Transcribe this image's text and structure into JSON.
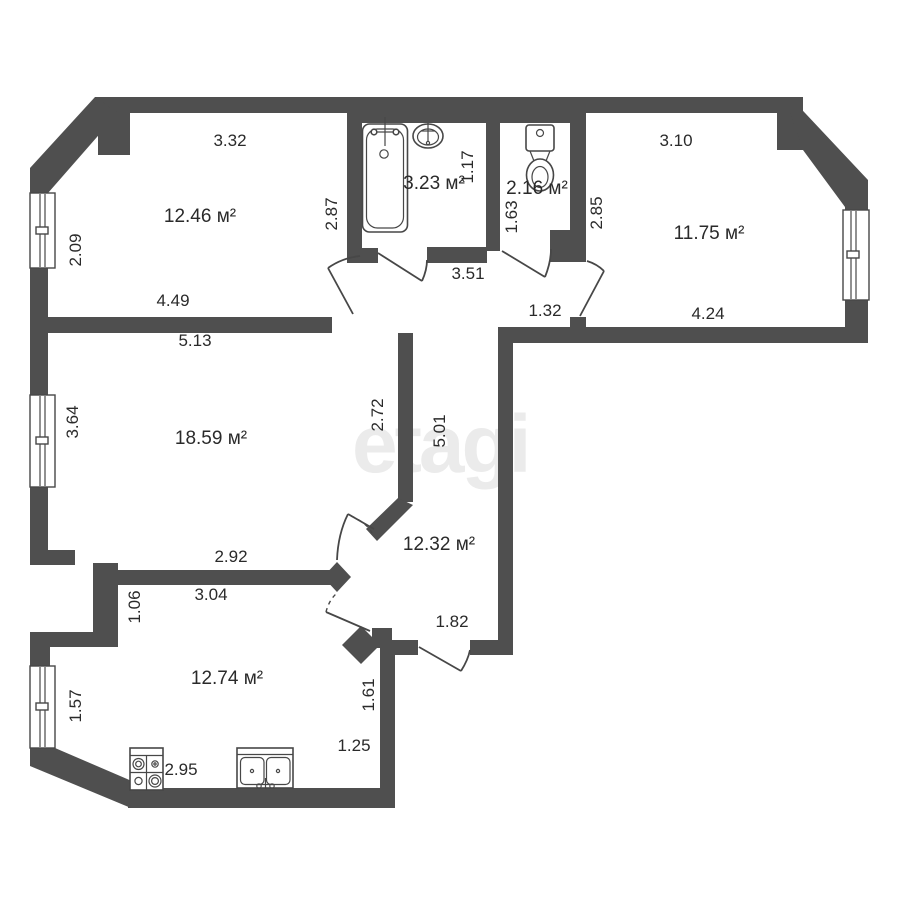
{
  "watermark": "etagi",
  "colors": {
    "wall": "#4f4f4f",
    "line": "#474747",
    "text": "#2a2a2a",
    "watermark": "#ebebeb"
  },
  "plan": {
    "type": "apartment-floor-plan",
    "area_unit": "м²",
    "rooms": [
      {
        "name": "room-12-46",
        "label": "12.46 м²",
        "x": 200,
        "y": 217
      },
      {
        "name": "bathroom",
        "label": "3.23 м²",
        "x": 434,
        "y": 184
      },
      {
        "name": "wc",
        "label": "2.16 м²",
        "x": 537,
        "y": 189
      },
      {
        "name": "room-11-75",
        "label": "11.75 м²",
        "x": 709,
        "y": 234
      },
      {
        "name": "room-18-59",
        "label": "18.59 м²",
        "x": 211,
        "y": 439
      },
      {
        "name": "hallway",
        "label": "12.32 м²",
        "x": 439,
        "y": 545
      },
      {
        "name": "kitchen",
        "label": "12.74 м²",
        "x": 227,
        "y": 679
      }
    ],
    "dimensions": [
      {
        "value": "3.32",
        "x": 230,
        "y": 141,
        "vertical": false
      },
      {
        "value": "1.17",
        "x": 468,
        "y": 167,
        "vertical": true
      },
      {
        "value": "3.10",
        "x": 676,
        "y": 141,
        "vertical": false
      },
      {
        "value": "2.09",
        "x": 76,
        "y": 250,
        "vertical": true
      },
      {
        "value": "2.87",
        "x": 332,
        "y": 214,
        "vertical": true
      },
      {
        "value": "1.63",
        "x": 512,
        "y": 217,
        "vertical": true
      },
      {
        "value": "2.85",
        "x": 597,
        "y": 213,
        "vertical": true
      },
      {
        "value": "4.49",
        "x": 173,
        "y": 301,
        "vertical": false
      },
      {
        "value": "3.51",
        "x": 468,
        "y": 274,
        "vertical": false
      },
      {
        "value": "1.32",
        "x": 545,
        "y": 311,
        "vertical": false
      },
      {
        "value": "4.24",
        "x": 708,
        "y": 314,
        "vertical": false
      },
      {
        "value": "5.13",
        "x": 195,
        "y": 341,
        "vertical": false
      },
      {
        "value": "3.64",
        "x": 73,
        "y": 422,
        "vertical": true
      },
      {
        "value": "2.72",
        "x": 378,
        "y": 415,
        "vertical": true
      },
      {
        "value": "5.01",
        "x": 440,
        "y": 431,
        "vertical": true
      },
      {
        "value": "2.92",
        "x": 231,
        "y": 557,
        "vertical": false
      },
      {
        "value": "3.04",
        "x": 211,
        "y": 595,
        "vertical": false
      },
      {
        "value": "1.06",
        "x": 135,
        "y": 607,
        "vertical": true
      },
      {
        "value": "1.82",
        "x": 452,
        "y": 622,
        "vertical": false
      },
      {
        "value": "1.57",
        "x": 76,
        "y": 706,
        "vertical": true
      },
      {
        "value": "1.61",
        "x": 369,
        "y": 695,
        "vertical": true
      },
      {
        "value": "1.25",
        "x": 354,
        "y": 746,
        "vertical": false
      },
      {
        "value": "2.95",
        "x": 181,
        "y": 770,
        "vertical": false
      }
    ],
    "fixtures": [
      {
        "name": "bathtub"
      },
      {
        "name": "washbasin"
      },
      {
        "name": "toilet"
      },
      {
        "name": "stove"
      },
      {
        "name": "kitchen-sink"
      }
    ],
    "windows_count": 4,
    "doors_count": 7
  }
}
